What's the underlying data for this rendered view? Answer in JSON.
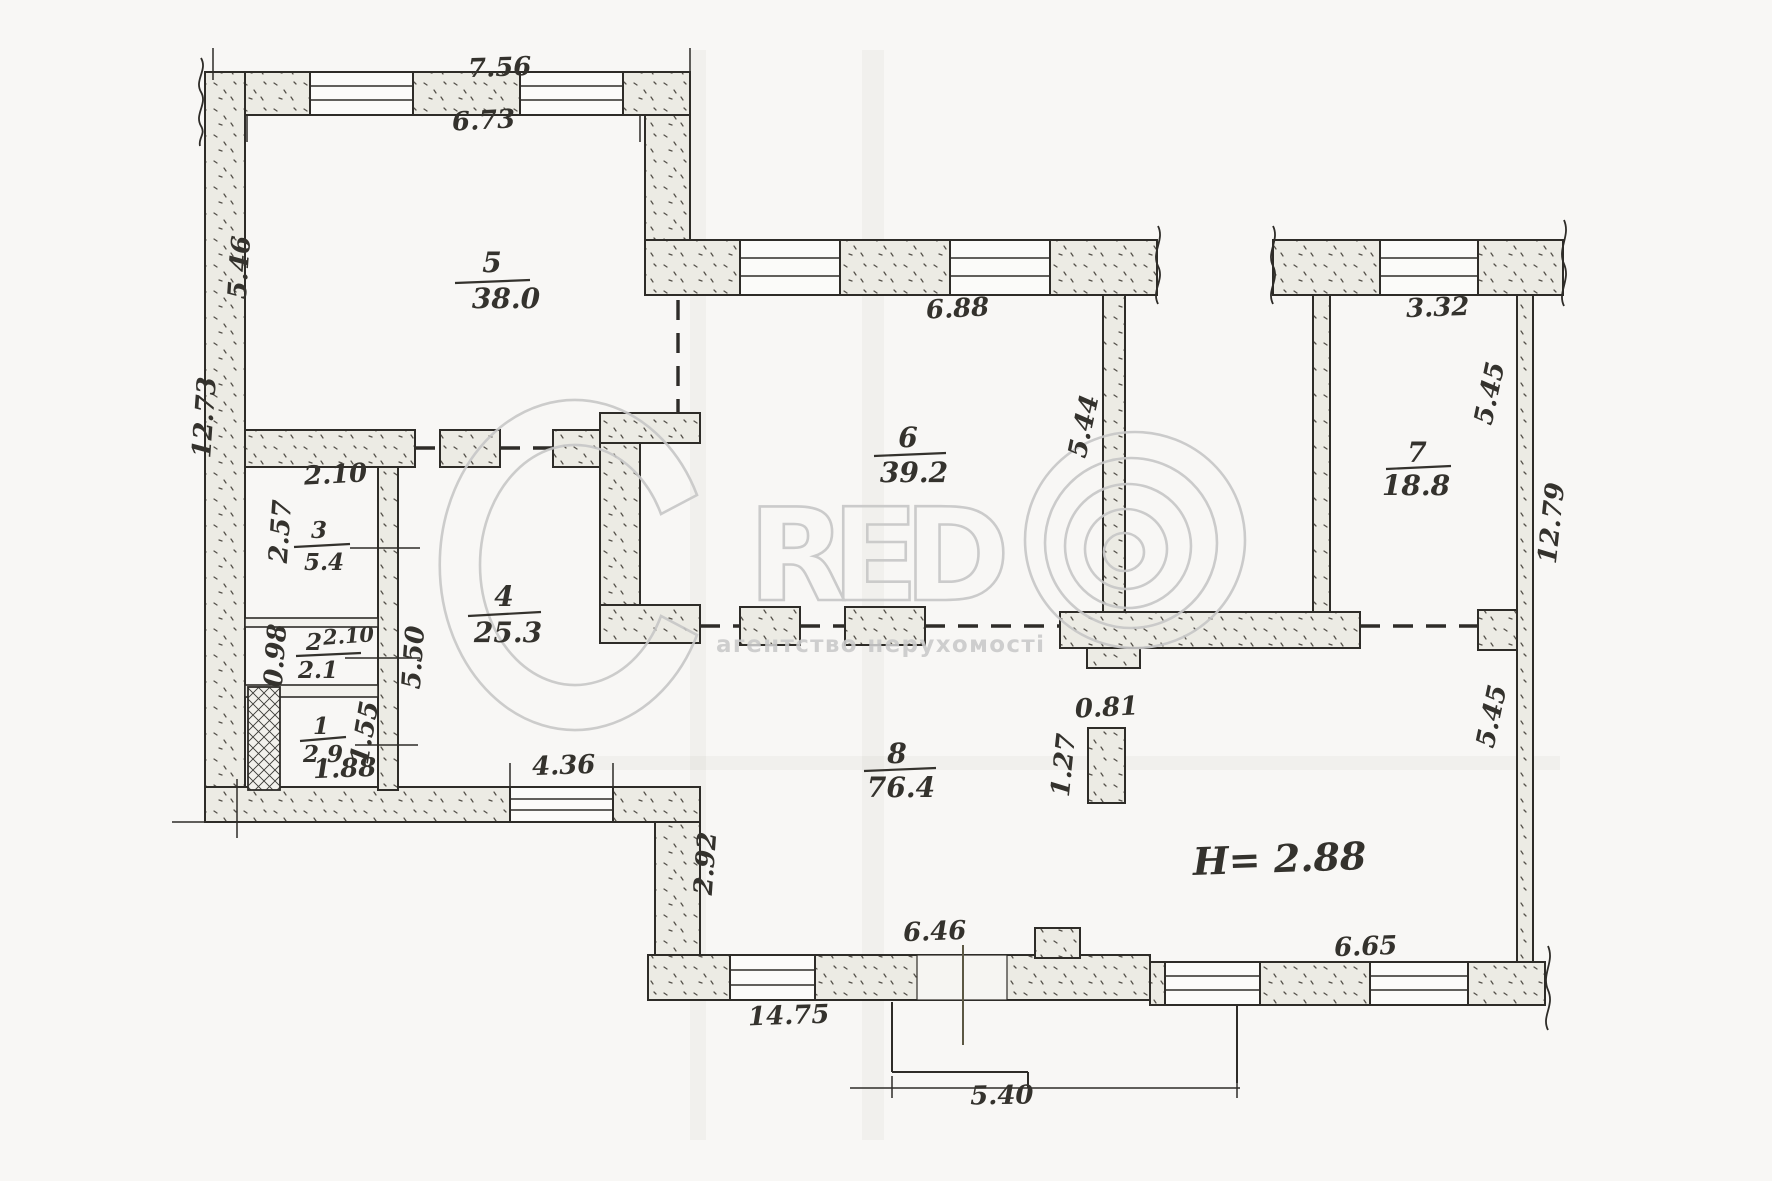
{
  "plan": {
    "rooms": {
      "r1": {
        "number": "1",
        "area": "2.9"
      },
      "r2": {
        "number": "2",
        "area": "2.1"
      },
      "r3": {
        "number": "3",
        "area": "5.4"
      },
      "r4": {
        "number": "4",
        "area": "25.3"
      },
      "r5": {
        "number": "5",
        "area": "38.0"
      },
      "r6": {
        "number": "6",
        "area": "39.2"
      },
      "r7": {
        "number": "7",
        "area": "18.8"
      },
      "r8": {
        "number": "8",
        "area": "76.4"
      }
    },
    "dims": {
      "top_756": "7.56",
      "top_673": "6.73",
      "left_546": "5.46",
      "left_1273": "12.73",
      "r3_width": "2.10",
      "r3_height": "2.57",
      "r2_height": "0.98",
      "r2_width": "2.10",
      "r4_height": "5.50",
      "r1_height": "1.55",
      "r1_width": "1.88",
      "win_436": "4.36",
      "left8_292": "2.92",
      "bottom_1475": "14.75",
      "door_646": "6.46",
      "porch_540": "5.40",
      "bottom_665": "6.65",
      "r6_top_688": "6.88",
      "r6_right_544": "5.44",
      "r7_top_332": "3.32",
      "r7_right_545": "5.45",
      "right_1279": "12.79",
      "right_545b": "5.45",
      "col_081": "0.81",
      "col_127": "1.27"
    },
    "ceiling_height": "H= 2.88"
  },
  "watermark": {
    "letters": "RED",
    "tagline": "агентство нерухомості"
  }
}
